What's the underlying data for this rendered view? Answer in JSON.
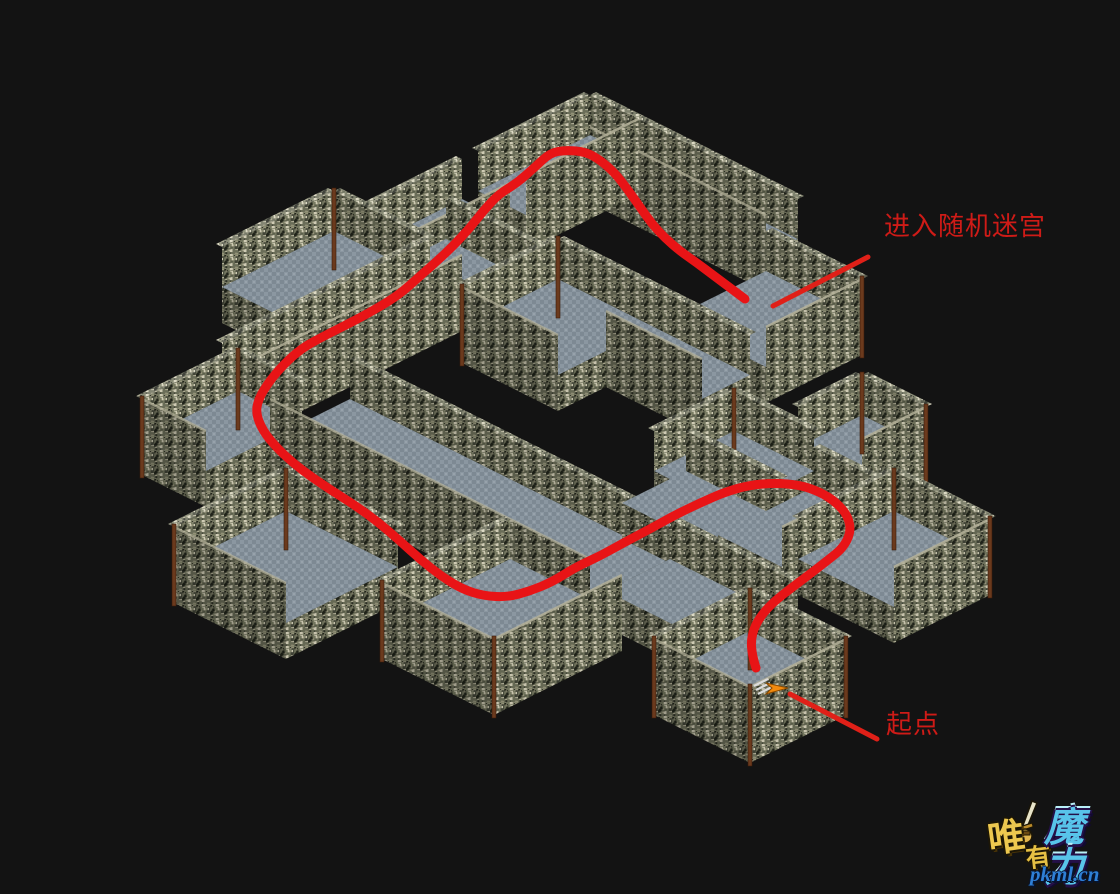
{
  "scene": {
    "background": "#131313",
    "description": "isometric dungeon maze map with annotated walkthrough route"
  },
  "map": {
    "iso": {
      "origin_x": 590,
      "origin_y": 135,
      "tile_w": 16,
      "tile_h": 8,
      "extrude": 36,
      "parapet": 40
    },
    "colors": {
      "floor_base": "#8b97a1",
      "floor_check": "#7d8993",
      "floor_speck": "#97a2ab",
      "wall_base": "#6f725c",
      "wall_speckles": [
        "#cdc9ae",
        "#b7b399",
        "#a19e83",
        "#7d8066",
        "#5f624e",
        "#45483a",
        "#2e3126",
        "#8b8e72",
        "#d8d4bc",
        "#23261c"
      ],
      "wall_top_line": "#b5b29a",
      "pillar": "#6b3a1d",
      "pillar_edge": "#3a1c0a"
    },
    "platforms": [
      {
        "name": "apex-right-corridor",
        "rect": [
          0,
          0,
          13,
          2
        ],
        "parapets": [
          "ne",
          "sw"
        ]
      },
      {
        "name": "apex-left-corridor",
        "rect": [
          0,
          0,
          3,
          7
        ],
        "parapets": [
          "nw",
          "se"
        ]
      },
      {
        "name": "upper-left-corridor",
        "rect": [
          0,
          8,
          3,
          15
        ],
        "parapets": [
          "nw",
          "se"
        ]
      },
      {
        "name": "upper-left-room",
        "rect": [
          -2,
          14,
          4,
          21
        ],
        "parapets": [
          "nw",
          "ne"
        ]
      },
      {
        "name": "center-connector",
        "rect": [
          2,
          11,
          8,
          13
        ],
        "parapets": [
          "ne"
        ]
      },
      {
        "name": "enter-maze-room",
        "rect": [
          14,
          3,
          20,
          9
        ],
        "parapets": [
          "ne",
          "se"
        ]
      },
      {
        "name": "mid-left-corridor",
        "rect": [
          4,
          14,
          6,
          27
        ],
        "parapets": [
          "nw",
          "se"
        ]
      },
      {
        "name": "center-room",
        "rect": [
          8,
          10,
          14,
          16
        ],
        "parapets": [
          "nw",
          "ne",
          "sw"
        ]
      },
      {
        "name": "center-right-corridor",
        "rect": [
          14,
          10,
          20,
          13
        ],
        "parapets": [
          "ne",
          "sw"
        ]
      },
      {
        "name": "far-left-room",
        "rect": [
          5,
          27,
          9,
          33
        ],
        "parapets": [
          "nw",
          "ne",
          "sw"
        ]
      },
      {
        "name": "right-mid-room",
        "rect": [
          23,
          14,
          28,
          19
        ],
        "parapets": [
          "nw",
          "ne"
        ]
      },
      {
        "name": "wide-corridor",
        "rect": [
          9,
          24,
          29,
          29
        ],
        "parapets": [
          "ne",
          "sw"
        ]
      },
      {
        "name": "right-upper-room",
        "rect": [
          26,
          9,
          30,
          13
        ],
        "parapets": [
          "nw",
          "ne",
          "se"
        ]
      },
      {
        "name": "right-connector",
        "rect": [
          24,
          18,
          30,
          22
        ],
        "parapets": [
          "ne"
        ]
      },
      {
        "name": "uturn-room",
        "rect": [
          29,
          15,
          33,
          21
        ],
        "parapets": [
          "ne",
          "se"
        ]
      },
      {
        "name": "far-right-room",
        "rect": [
          33,
          14,
          39,
          20
        ],
        "parapets": [
          "nw",
          "ne",
          "se"
        ]
      },
      {
        "name": "bottom-left-room",
        "rect": [
          14,
          33,
          21,
          40
        ],
        "parapets": [
          "nw",
          "ne",
          "sw"
        ]
      },
      {
        "name": "lower-connector",
        "rect": [
          29,
          24,
          37,
          28
        ],
        "parapets": [
          "ne"
        ]
      },
      {
        "name": "bottom-center-room",
        "rect": [
          24,
          29,
          31,
          37
        ],
        "parapets": [
          "nw",
          "sw",
          "se"
        ]
      },
      {
        "name": "start-room",
        "rect": [
          36,
          26,
          42,
          32
        ],
        "parapets": [
          "nw",
          "ne",
          "se",
          "sw"
        ]
      }
    ]
  },
  "route": {
    "color": "#e81416",
    "width": 9,
    "points": [
      [
        756,
        668
      ],
      [
        752,
        655
      ],
      [
        751,
        638
      ],
      [
        757,
        621
      ],
      [
        771,
        604
      ],
      [
        790,
        589
      ],
      [
        810,
        574
      ],
      [
        828,
        560
      ],
      [
        843,
        548
      ],
      [
        851,
        532
      ],
      [
        848,
        516
      ],
      [
        836,
        502
      ],
      [
        820,
        492
      ],
      [
        800,
        485
      ],
      [
        775,
        483
      ],
      [
        750,
        485
      ],
      [
        725,
        492
      ],
      [
        700,
        503
      ],
      [
        675,
        515
      ],
      [
        650,
        529
      ],
      [
        625,
        542
      ],
      [
        600,
        556
      ],
      [
        576,
        567
      ],
      [
        552,
        582
      ],
      [
        530,
        591
      ],
      [
        508,
        597
      ],
      [
        484,
        596
      ],
      [
        462,
        589
      ],
      [
        441,
        576
      ],
      [
        421,
        560
      ],
      [
        400,
        541
      ],
      [
        378,
        522
      ],
      [
        356,
        506
      ],
      [
        334,
        492
      ],
      [
        313,
        478
      ],
      [
        293,
        463
      ],
      [
        276,
        447
      ],
      [
        263,
        431
      ],
      [
        256,
        414
      ],
      [
        258,
        400
      ],
      [
        268,
        383
      ],
      [
        283,
        365
      ],
      [
        302,
        348
      ],
      [
        324,
        336
      ],
      [
        350,
        323
      ],
      [
        376,
        309
      ],
      [
        400,
        294
      ],
      [
        420,
        276
      ],
      [
        436,
        262
      ],
      [
        452,
        247
      ],
      [
        469,
        229
      ],
      [
        484,
        210
      ],
      [
        499,
        194
      ],
      [
        517,
        183
      ],
      [
        535,
        167
      ],
      [
        550,
        153
      ],
      [
        566,
        150
      ],
      [
        586,
        152
      ],
      [
        600,
        160
      ],
      [
        615,
        173
      ],
      [
        628,
        190
      ],
      [
        640,
        207
      ],
      [
        652,
        224
      ],
      [
        665,
        238
      ],
      [
        680,
        251
      ],
      [
        697,
        263
      ],
      [
        713,
        275
      ],
      [
        729,
        287
      ],
      [
        745,
        299
      ]
    ]
  },
  "annotations": [
    {
      "id": "enter-maze",
      "label": "进入随机迷宫",
      "color": "#cf1b17",
      "text_x": 884,
      "text_y": 214,
      "font_size": 26,
      "line": {
        "x1": 868,
        "y1": 257,
        "x2": 773,
        "y2": 306,
        "width": 5,
        "color": "#e02018"
      }
    },
    {
      "id": "start",
      "label": "起点",
      "color": "#cf1b17",
      "text_x": 886,
      "text_y": 712,
      "font_size": 26,
      "line": {
        "x1": 790,
        "y1": 694,
        "x2": 877,
        "y2": 739,
        "width": 5,
        "color": "#e02018"
      }
    }
  ],
  "start_marker": {
    "x": 772,
    "y": 688,
    "arrow_color": "#f28a0e",
    "arrow_edge": "#8a4a00",
    "slat_color": "#dcdcdc"
  },
  "watermark": {
    "char_wei": "唯",
    "char_you": "有",
    "text_magic": "魔力",
    "site_url": "pkml.cn",
    "gold": "#edc84f",
    "cyan": "#58c4ea",
    "blue": "#2e7fd6"
  }
}
